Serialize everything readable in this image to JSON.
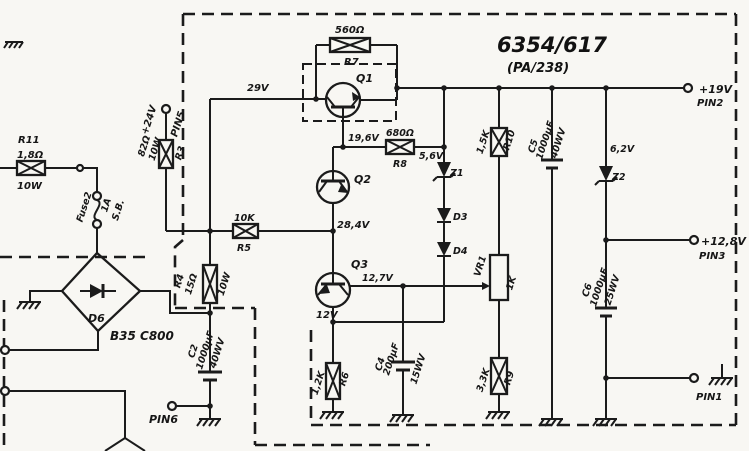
{
  "diagram": {
    "title": "6354/617",
    "subtitle": "(PA/238)"
  },
  "components": {
    "r11": {
      "name": "R11",
      "value": "1,8Ω",
      "power": "10W"
    },
    "fuse2": {
      "name": "Fuse2",
      "rating": "1A",
      "type": "S.B."
    },
    "d6": {
      "name": "D6",
      "part": "B35 C800"
    },
    "r3": {
      "name": "R3",
      "value": "82Ω",
      "power": "10W"
    },
    "r4": {
      "name": "R4",
      "value": "15Ω",
      "power": "10W"
    },
    "r5": {
      "name": "R5",
      "value": "10K"
    },
    "r6": {
      "name": "R6",
      "value": "1,2K"
    },
    "r7": {
      "name": "R7",
      "value": "560Ω"
    },
    "r8": {
      "name": "R8",
      "value": "680Ω"
    },
    "r9": {
      "name": "R9",
      "value": "3,3K"
    },
    "r10": {
      "name": "R10",
      "value": "1,5K"
    },
    "vr1": {
      "name": "VR1",
      "value": "1K"
    },
    "c2": {
      "name": "C2",
      "value": "1000μF",
      "rating": "40WV"
    },
    "c4": {
      "name": "C4",
      "value": "200μF",
      "rating": "15WV"
    },
    "c5": {
      "name": "C5",
      "value": "1000μF",
      "rating": "40WV"
    },
    "c6": {
      "name": "C6",
      "value": "1000μF",
      "rating": "25WV"
    },
    "q1": {
      "name": "Q1"
    },
    "q2": {
      "name": "Q2"
    },
    "q3": {
      "name": "Q3"
    },
    "z1": {
      "name": "Z1",
      "value": "5,6V"
    },
    "z2": {
      "name": "Z2",
      "value": "6,2V"
    },
    "d3": {
      "name": "D3"
    },
    "d4": {
      "name": "D4"
    }
  },
  "pins": {
    "pin1": {
      "name": "PIN1"
    },
    "pin2": {
      "name": "PIN2",
      "voltage": "+19V"
    },
    "pin3": {
      "name": "PIN3",
      "voltage": "+12,8V"
    },
    "pin5": {
      "name": "PIN5",
      "voltage": "+24V"
    },
    "pin6": {
      "name": "PIN6"
    }
  },
  "test_voltages": {
    "v29": "29V",
    "v19_6": "19,6V",
    "v28_4": "28,4V",
    "v12_7": "12,7V",
    "v12": "12V"
  }
}
